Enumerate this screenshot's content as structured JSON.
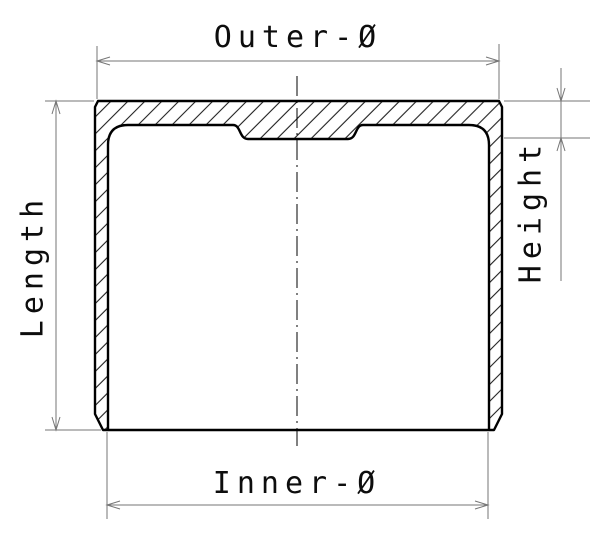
{
  "labels": {
    "outer_diameter": "Outer-Ø",
    "inner_diameter": "Inner-Ø",
    "length": "Length",
    "height": "Height"
  },
  "colors": {
    "outline": "#000000",
    "hatching": "#1f1f1f",
    "dimension_lines": "#767676",
    "label_text": "#0d0d0d",
    "background": "#ffffff"
  }
}
